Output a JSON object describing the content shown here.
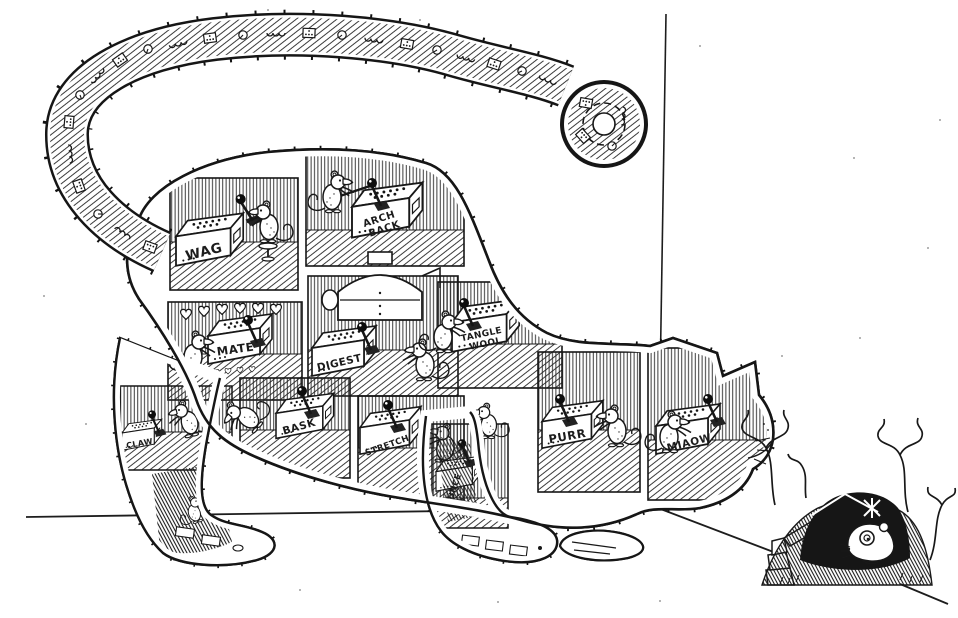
{
  "scene": {
    "ink_color": "#181818",
    "paper_color": "#ffffff"
  },
  "rooms": {
    "wag": {
      "label": "WAG"
    },
    "arch_back": {
      "line1": "ARCH",
      "line2": "BACK"
    },
    "mate": {
      "label": "MATE"
    },
    "digest": {
      "label": "DIGEST"
    },
    "tangle_wool": {
      "line1": "TANGLE",
      "line2": "WOOL"
    },
    "claw": {
      "label": "CLAW"
    },
    "bask": {
      "label": "BASK"
    },
    "stretch": {
      "label": "STRETCH"
    },
    "pounce": {
      "label": "POUNCE"
    },
    "purr": {
      "label": "PURR"
    },
    "miaow": {
      "label": "MIAOW"
    }
  }
}
